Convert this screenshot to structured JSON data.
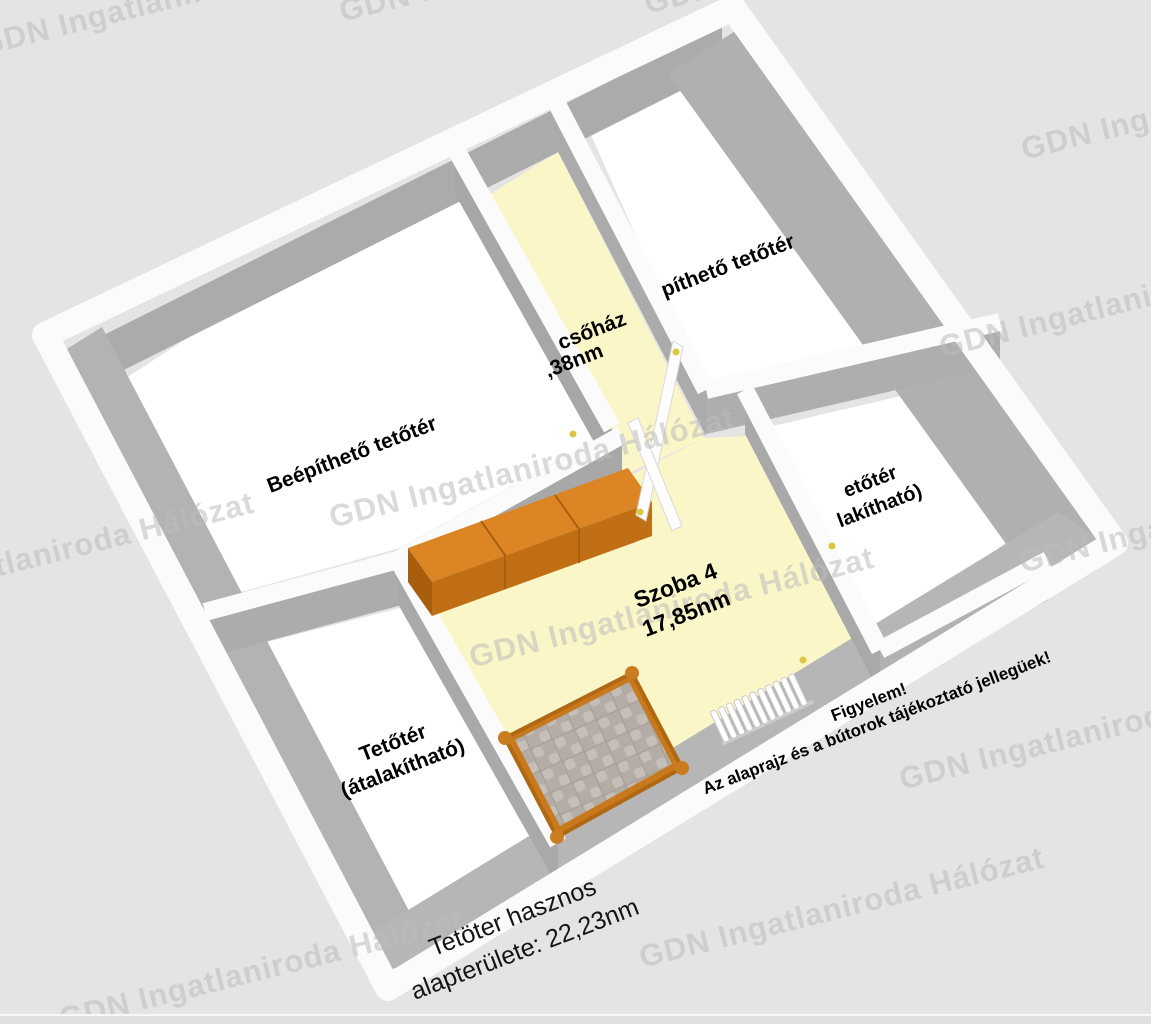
{
  "watermark": {
    "text": "GDN Ingatlaniroda Hálózat",
    "color": "#bdbdbd"
  },
  "floorplan": {
    "rooms": {
      "beepitheto": {
        "label": "Beépíthető tetőtér"
      },
      "lepcsohaz": {
        "line1": "csőház",
        "line2": ",38nm"
      },
      "pitheto": {
        "label": "píthető tetőtér"
      },
      "szoba4": {
        "name": "Szoba 4",
        "area": "17,85nm"
      },
      "tetoter_right": {
        "line1": "etőtér",
        "line2": "lakítható)"
      },
      "tetoter_left": {
        "line1": "Tetőtér",
        "line2": "(átalakítható)"
      }
    },
    "summary": {
      "line1": "Tetöter hasznos",
      "line2": "alapterülete: 22,23nm"
    },
    "disclaimer": {
      "line1": "Figyelem!",
      "line2": "Az alaprajz és a bútorok tájékoztató jellegüek!"
    },
    "colors": {
      "background": "#e4e4e4",
      "floor_heated": "#FBF6C8",
      "floor_unheated": "#ffffff",
      "wall_top": "#fbfbfb",
      "wall_side": "#ababab",
      "furniture_orange_top": "#DC8524",
      "furniture_orange_front": "#C06F15",
      "mattress_light": "#c5bfb7",
      "mattress_dark": "#b3ada5",
      "handle_dot": "#DFC545"
    }
  }
}
